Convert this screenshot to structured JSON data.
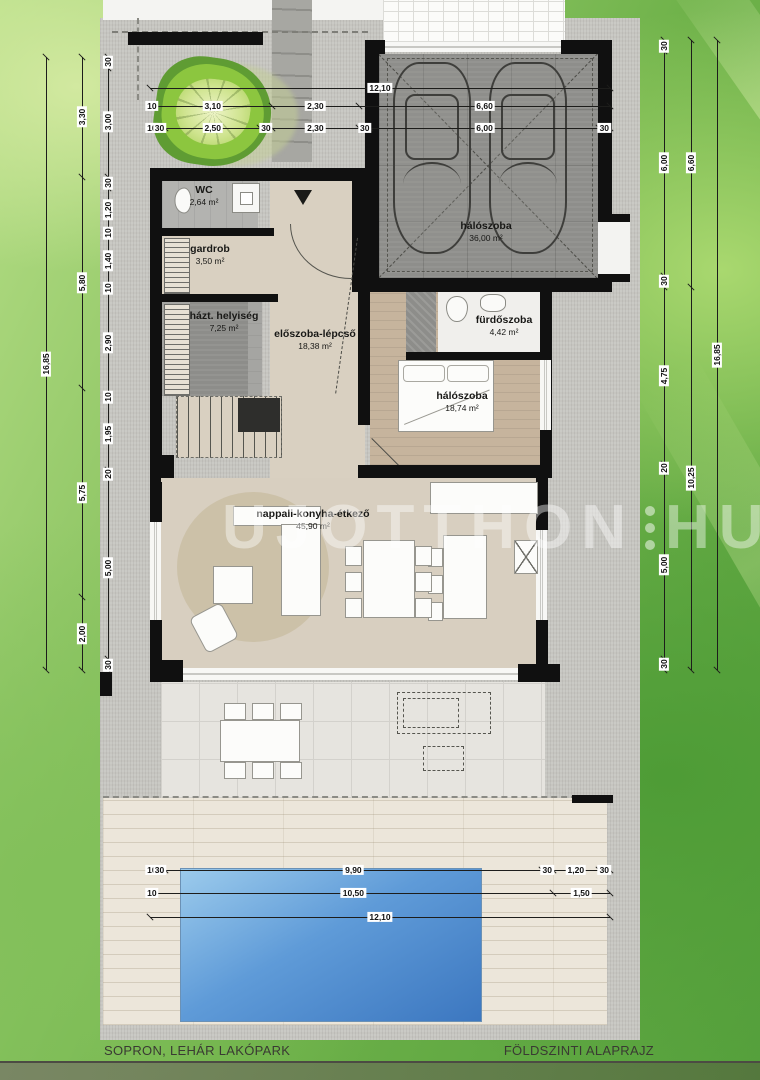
{
  "document": {
    "project": "SOPRON, LEHÁR LAKÓPARK",
    "drawing": "FÖLDSZINTI ALAPRAJZ"
  },
  "watermark": {
    "part1": "UJOTTHON",
    "part2": "HU"
  },
  "rooms": {
    "wc": {
      "name": "WC",
      "area": "2,64 m²"
    },
    "gardrob": {
      "name": "gardrob",
      "area": "3,50 m²"
    },
    "hazt": {
      "name": "házt. helyiség",
      "area": "7,25 m²"
    },
    "eloszoba": {
      "name": "előszoba-lépcső",
      "area": "18,38 m²"
    },
    "garaz": {
      "name": "hálószoba",
      "area": "36,00 m²"
    },
    "furdo": {
      "name": "fürdőszoba",
      "area": "4,42 m²"
    },
    "halo": {
      "name": "hálószoba",
      "area": "18,74 m²"
    },
    "nappali": {
      "name": "nappali-konyha-étkező",
      "area": "45,90 m²"
    }
  },
  "dimensions": {
    "left": {
      "overall": [
        "16,85"
      ],
      "middle": [
        "3,30",
        "5,80",
        "5,75",
        "2,00"
      ],
      "inner": [
        "30",
        "3,00",
        "30",
        "1,20",
        "10",
        "1,40",
        "10",
        "2,90",
        "10",
        "1,95",
        "20",
        "5,00",
        "30"
      ]
    },
    "right": {
      "overall": [
        "16,85"
      ],
      "middle": [
        "6,60",
        "10,25"
      ],
      "inner": [
        "30",
        "6,00",
        "30",
        "4,75",
        "20",
        "5,00",
        "30"
      ]
    },
    "top": {
      "overall": [
        "12,10"
      ],
      "middle": [
        "10",
        "3,10",
        "2,30",
        "6,60"
      ],
      "inner": [
        "10",
        "30",
        "2,50",
        "30",
        "2,30",
        "30",
        "6,00",
        "30"
      ]
    },
    "bottom": {
      "line1": [
        "10",
        "30",
        "9,90",
        "30",
        "1,20",
        "30"
      ],
      "line2": [
        "10",
        "10,50",
        "1,50"
      ],
      "line3": [
        "12,10"
      ]
    }
  }
}
